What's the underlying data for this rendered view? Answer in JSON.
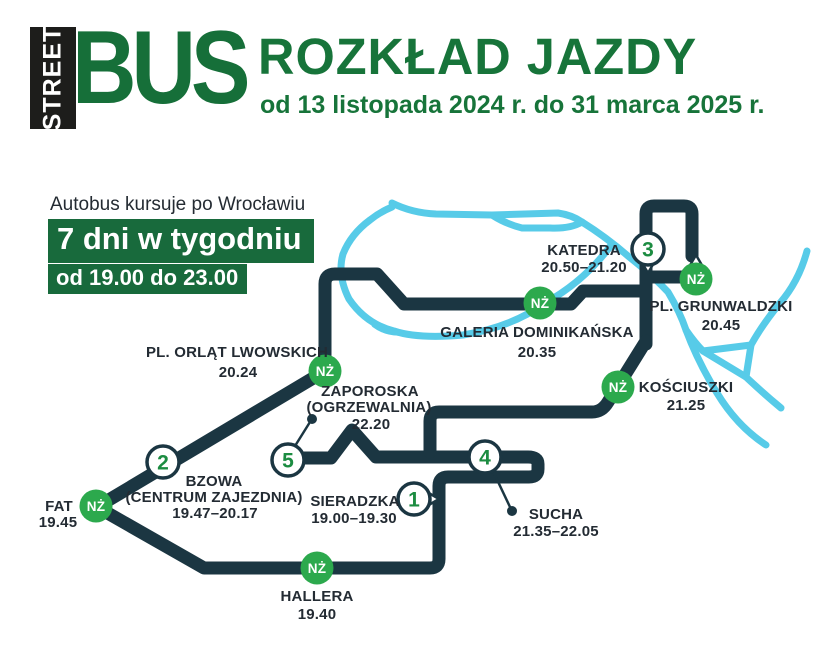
{
  "header": {
    "logo_vertical": "STREET",
    "logo_main": "BUS",
    "title": "ROZKŁAD JAZDY",
    "subtitle": "od 13 listopada 2024 r. do 31 marca 2025 r."
  },
  "info": {
    "line1": "Autobus kursuje po Wrocławiu",
    "days": "7 dni w tygodniu",
    "hours": "od 19.00 do 23.00"
  },
  "badges": {
    "request_stop": "NŻ"
  },
  "stops": [
    {
      "num": "1",
      "name": "SIERADZKA",
      "time": "19.00–19.30"
    },
    {
      "num": "",
      "name": "HALLERA",
      "time": "19.40",
      "request_stop": true
    },
    {
      "num": "",
      "name": "FAT",
      "time": "19.45",
      "request_stop": true
    },
    {
      "num": "2",
      "name": "BZOWA",
      "name2": "(CENTRUM ZAJEZDNIA)",
      "time": "19.47–20.17"
    },
    {
      "num": "",
      "name": "PL. ORLĄT LWOWSKICH",
      "time": "20.24",
      "request_stop": true
    },
    {
      "num": "",
      "name": "GALERIA DOMINIKAŃSKA",
      "time": "20.35",
      "request_stop": true
    },
    {
      "num": "",
      "name": "PL. GRUNWALDZKI",
      "time": "20.45",
      "request_stop": true
    },
    {
      "num": "3",
      "name": "KATEDRA",
      "time": "20.50–21.20"
    },
    {
      "num": "",
      "name": "KOŚCIUSZKI",
      "time": "21.25",
      "request_stop": true
    },
    {
      "num": "4",
      "name": "SUCHA",
      "time": "21.35–22.05"
    },
    {
      "num": "5",
      "name": "ZAPOROSKA",
      "name2": "(OGRZEWALNIA)",
      "time": "22.20"
    }
  ],
  "colors": {
    "green_dark": "#166f39",
    "green_badge": "#2ca94d",
    "green_number": "#1c8c41",
    "route_navy": "#1b3642",
    "river_cyan": "#57cbe8"
  }
}
